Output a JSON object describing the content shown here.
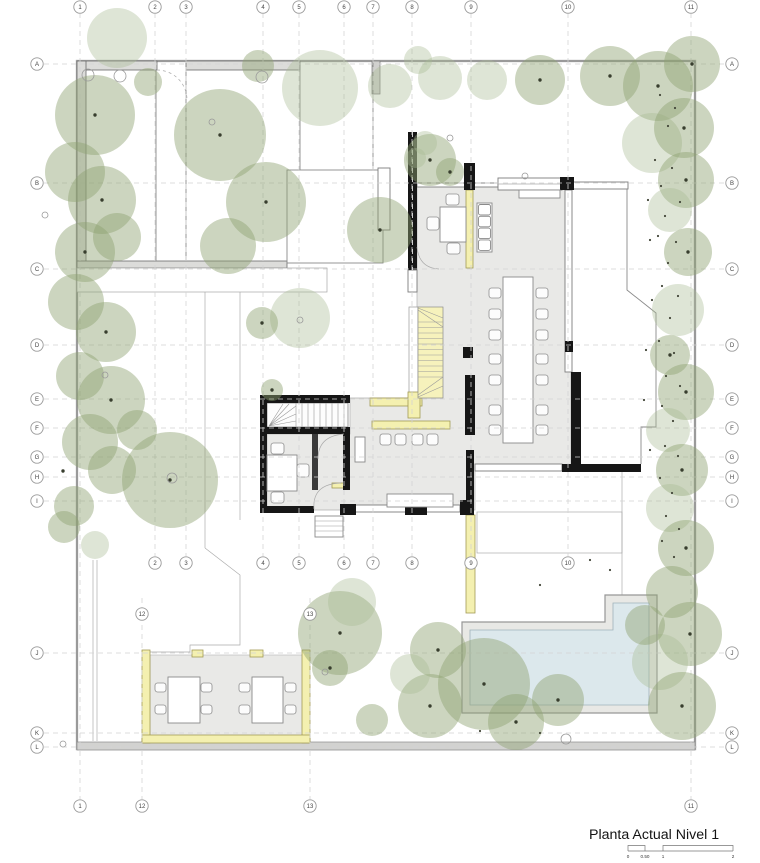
{
  "colors": {
    "tree": "#8fa170",
    "tree_light": "#a9ba93",
    "floor": "#e9e9e7",
    "wall_black": "#161616",
    "yellow_fill": "#f4f0b0",
    "yellow_edge": "#a29a55",
    "pool_water": "#dce8ec",
    "pool_deck": "#e8e8e5",
    "grid_line": "#d4d4d4",
    "outline": "#8a8a8a",
    "dot": "#383e2e",
    "text": "#141414"
  },
  "title": {
    "text": "Planta Actual Nivel 1"
  },
  "scale_bar": {
    "labels": [
      {
        "text": "0",
        "x": 628
      },
      {
        "text": "0.50",
        "x": 645
      },
      {
        "text": "1",
        "x": 663
      },
      {
        "text": "2",
        "x": 733
      }
    ]
  },
  "grid": {
    "top": [
      [
        "1",
        80
      ],
      [
        "2",
        155
      ],
      [
        "3",
        186
      ],
      [
        "4",
        263
      ],
      [
        "5",
        299
      ],
      [
        "6",
        344
      ],
      [
        "7",
        373
      ],
      [
        "8",
        412
      ],
      [
        "9",
        471
      ],
      [
        "10",
        568
      ],
      [
        "11",
        691
      ]
    ],
    "mid": [
      [
        "2",
        155
      ],
      [
        "3",
        186
      ],
      [
        "4",
        263
      ],
      [
        "5",
        299
      ],
      [
        "6",
        344
      ],
      [
        "7",
        373
      ],
      [
        "8",
        412
      ],
      [
        "9",
        471
      ],
      [
        "10",
        568
      ]
    ],
    "inner": [
      [
        "12",
        142
      ],
      [
        "13",
        310
      ]
    ],
    "bottom": [
      [
        "1",
        80
      ],
      [
        "12",
        142
      ],
      [
        "13",
        310
      ],
      [
        "11",
        691
      ]
    ],
    "rows": [
      [
        "A",
        64
      ],
      [
        "B",
        183
      ],
      [
        "C",
        269
      ],
      [
        "D",
        345
      ],
      [
        "E",
        399
      ],
      [
        "F",
        428
      ],
      [
        "G",
        457
      ],
      [
        "H",
        477
      ],
      [
        "I",
        501
      ],
      [
        "J",
        653
      ],
      [
        "K",
        733
      ],
      [
        "L",
        747
      ]
    ]
  },
  "trees": [
    [
      117,
      38,
      30,
      1
    ],
    [
      148,
      82,
      14,
      0
    ],
    [
      258,
      66,
      16,
      0
    ],
    [
      220,
      135,
      46,
      0
    ],
    [
      266,
      202,
      40,
      0
    ],
    [
      228,
      246,
      28,
      0
    ],
    [
      320,
      88,
      38,
      1
    ],
    [
      390,
      86,
      22,
      1
    ],
    [
      418,
      60,
      14,
      1
    ],
    [
      430,
      160,
      26,
      0
    ],
    [
      425,
      143,
      12,
      1
    ],
    [
      416,
      158,
      10,
      1
    ],
    [
      450,
      172,
      14,
      0
    ],
    [
      380,
      230,
      33,
      0
    ],
    [
      300,
      318,
      30,
      1
    ],
    [
      262,
      323,
      16,
      0
    ],
    [
      272,
      390,
      11,
      0
    ],
    [
      440,
      78,
      22,
      1
    ],
    [
      487,
      80,
      20,
      1
    ],
    [
      540,
      80,
      25,
      0
    ],
    [
      610,
      76,
      30,
      0
    ],
    [
      658,
      86,
      35,
      0
    ],
    [
      692,
      64,
      28,
      0
    ],
    [
      652,
      143,
      30,
      1
    ],
    [
      684,
      128,
      30,
      0
    ],
    [
      686,
      180,
      28,
      0
    ],
    [
      670,
      210,
      22,
      1
    ],
    [
      688,
      252,
      24,
      0
    ],
    [
      678,
      310,
      26,
      1
    ],
    [
      670,
      355,
      20,
      0
    ],
    [
      686,
      392,
      28,
      0
    ],
    [
      668,
      430,
      22,
      1
    ],
    [
      682,
      470,
      26,
      0
    ],
    [
      670,
      508,
      24,
      1
    ],
    [
      686,
      548,
      28,
      0
    ],
    [
      672,
      592,
      26,
      0
    ],
    [
      690,
      634,
      32,
      0
    ],
    [
      660,
      662,
      28,
      1
    ],
    [
      682,
      706,
      34,
      0
    ],
    [
      645,
      625,
      20,
      0
    ],
    [
      95,
      115,
      40,
      0
    ],
    [
      75,
      172,
      30,
      0
    ],
    [
      102,
      200,
      34,
      0
    ],
    [
      85,
      252,
      30,
      0
    ],
    [
      117,
      237,
      24,
      0
    ],
    [
      76,
      302,
      28,
      0
    ],
    [
      106,
      332,
      30,
      0
    ],
    [
      80,
      376,
      24,
      0
    ],
    [
      111,
      400,
      34,
      0
    ],
    [
      90,
      442,
      28,
      0
    ],
    [
      137,
      430,
      20,
      0
    ],
    [
      112,
      470,
      24,
      0
    ],
    [
      74,
      506,
      20,
      0
    ],
    [
      64,
      527,
      16,
      0
    ],
    [
      170,
      480,
      48,
      0
    ],
    [
      95,
      545,
      14,
      1
    ],
    [
      340,
      633,
      42,
      0
    ],
    [
      352,
      602,
      24,
      1
    ],
    [
      330,
      668,
      18,
      0
    ],
    [
      438,
      650,
      28,
      0
    ],
    [
      484,
      684,
      46,
      0
    ],
    [
      430,
      706,
      32,
      0
    ],
    [
      516,
      722,
      28,
      0
    ],
    [
      558,
      700,
      26,
      0
    ],
    [
      410,
      674,
      20,
      1
    ],
    [
      372,
      720,
      16,
      0
    ]
  ],
  "trunk_dots": [
    [
      220,
      135
    ],
    [
      266,
      202
    ],
    [
      380,
      230
    ],
    [
      430,
      160
    ],
    [
      540,
      80
    ],
    [
      610,
      76
    ],
    [
      658,
      86
    ],
    [
      692,
      64
    ],
    [
      684,
      128
    ],
    [
      686,
      180
    ],
    [
      688,
      252
    ],
    [
      670,
      355
    ],
    [
      686,
      392
    ],
    [
      682,
      470
    ],
    [
      686,
      548
    ],
    [
      690,
      634
    ],
    [
      682,
      706
    ],
    [
      95,
      115
    ],
    [
      102,
      200
    ],
    [
      85,
      252
    ],
    [
      106,
      332
    ],
    [
      111,
      400
    ],
    [
      170,
      480
    ],
    [
      340,
      633
    ],
    [
      484,
      684
    ],
    [
      430,
      706
    ],
    [
      516,
      722
    ],
    [
      558,
      700
    ],
    [
      438,
      650
    ],
    [
      330,
      668
    ],
    [
      262,
      323
    ],
    [
      272,
      390
    ],
    [
      63,
      471
    ],
    [
      450,
      172
    ]
  ],
  "gravel_dots": [
    [
      660,
      95
    ],
    [
      675,
      108
    ],
    [
      668,
      126
    ],
    [
      655,
      160
    ],
    [
      672,
      168
    ],
    [
      661,
      186
    ],
    [
      680,
      202
    ],
    [
      665,
      216
    ],
    [
      658,
      236
    ],
    [
      676,
      242
    ],
    [
      668,
      263
    ],
    [
      662,
      286
    ],
    [
      678,
      296
    ],
    [
      670,
      318
    ],
    [
      659,
      341
    ],
    [
      674,
      353
    ],
    [
      666,
      376
    ],
    [
      680,
      386
    ],
    [
      662,
      406
    ],
    [
      673,
      421
    ],
    [
      665,
      446
    ],
    [
      678,
      456
    ],
    [
      660,
      478
    ],
    [
      672,
      493
    ],
    [
      666,
      516
    ],
    [
      679,
      529
    ],
    [
      662,
      541
    ],
    [
      674,
      557
    ],
    [
      648,
      200
    ],
    [
      650,
      240
    ],
    [
      652,
      300
    ],
    [
      646,
      350
    ],
    [
      644,
      400
    ],
    [
      650,
      450
    ],
    [
      590,
      560
    ],
    [
      540,
      585
    ],
    [
      610,
      570
    ],
    [
      480,
      731
    ],
    [
      540,
      733
    ]
  ],
  "site_circles": [
    [
      88,
      75,
      6
    ],
    [
      120,
      76,
      6
    ],
    [
      262,
      77,
      6
    ],
    [
      212,
      122,
      3
    ],
    [
      300,
      320,
      3
    ],
    [
      450,
      138,
      3
    ],
    [
      172,
      478,
      5
    ],
    [
      105,
      375,
      3
    ],
    [
      45,
      215,
      3
    ],
    [
      525,
      176,
      3
    ],
    [
      566,
      739,
      5
    ],
    [
      325,
      672,
      3
    ],
    [
      63,
      744,
      3
    ]
  ],
  "furniture": {
    "tables": [
      [
        503,
        277,
        30,
        166
      ],
      [
        440,
        207,
        26,
        35
      ],
      [
        267,
        455,
        30,
        36
      ],
      [
        168,
        677,
        32,
        46
      ],
      [
        252,
        677,
        31,
        46
      ],
      [
        519,
        190,
        41,
        8
      ],
      [
        387,
        494,
        66,
        13
      ],
      [
        355,
        437,
        10,
        25
      ]
    ],
    "chairs": [
      [
        489,
        288,
        12,
        10
      ],
      [
        489,
        309,
        12,
        10
      ],
      [
        489,
        330,
        12,
        10
      ],
      [
        489,
        354,
        12,
        10
      ],
      [
        489,
        375,
        12,
        10
      ],
      [
        489,
        405,
        12,
        10
      ],
      [
        489,
        425,
        12,
        10
      ],
      [
        536,
        288,
        12,
        10
      ],
      [
        536,
        309,
        12,
        10
      ],
      [
        536,
        330,
        12,
        10
      ],
      [
        536,
        354,
        12,
        10
      ],
      [
        536,
        375,
        12,
        10
      ],
      [
        536,
        405,
        12,
        10
      ],
      [
        536,
        425,
        12,
        10
      ],
      [
        446,
        194,
        13,
        11
      ],
      [
        427,
        217,
        12,
        13
      ],
      [
        447,
        243,
        13,
        11
      ],
      [
        271,
        443,
        13,
        11
      ],
      [
        271,
        492,
        13,
        11
      ],
      [
        297,
        464,
        12,
        13
      ],
      [
        380,
        434,
        11,
        11
      ],
      [
        395,
        434,
        11,
        11
      ],
      [
        412,
        434,
        11,
        11
      ],
      [
        427,
        434,
        11,
        11
      ],
      [
        155,
        683,
        11,
        9
      ],
      [
        155,
        705,
        11,
        9
      ],
      [
        201,
        683,
        11,
        9
      ],
      [
        201,
        705,
        11,
        9
      ],
      [
        239,
        683,
        11,
        9
      ],
      [
        239,
        705,
        11,
        9
      ],
      [
        285,
        683,
        11,
        9
      ],
      [
        285,
        705,
        11,
        9
      ]
    ]
  }
}
